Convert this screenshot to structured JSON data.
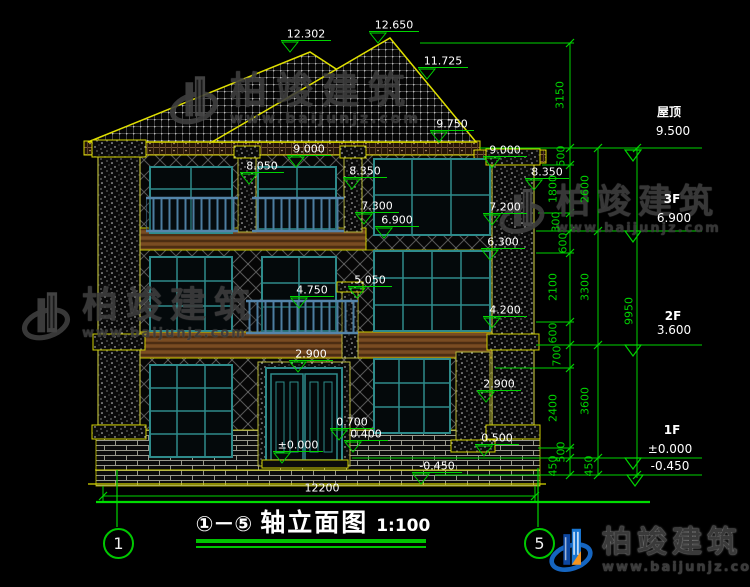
{
  "caption": {
    "axis_range": "①－⑤",
    "title": "轴立面图",
    "scale": "1:100"
  },
  "axes": {
    "left": "1",
    "right": "5"
  },
  "watermark": {
    "text": "柏竣建筑",
    "url": "www.baijunjz.com"
  },
  "logo": {
    "text": "柏竣建筑",
    "url": "www.baijunjz.com"
  },
  "levels": [
    {
      "label": "屋顶",
      "elevation": "9.500"
    },
    {
      "label": "3F",
      "elevation": "6.900"
    },
    {
      "label": "2F",
      "elevation": "3.600"
    },
    {
      "label": "1F",
      "elevation": "±0.000"
    },
    {
      "label": "室外地坪",
      "elevation": "-0.450"
    }
  ],
  "colors": {
    "background": "#000000",
    "dimension_green": "#00d400",
    "outline_yellow": "#d8d800",
    "window_teal": "#2e8b8b",
    "railing_blue": "#4d7da0",
    "wood_brown": "#6e431d",
    "watermark_gray": "#3d3d3d",
    "logo_blue": "#1565c0",
    "logo_orange": "#f5941d"
  },
  "annotations": [
    {
      "name": "elev-12302",
      "type": "level",
      "text": "12.302",
      "x": 306,
      "y": 34
    },
    {
      "name": "elev-12650",
      "type": "level",
      "text": "12.650",
      "x": 394,
      "y": 25
    },
    {
      "name": "elev-11725",
      "type": "level",
      "text": "11.725",
      "x": 443,
      "y": 61
    },
    {
      "name": "elev-9750",
      "type": "level",
      "text": "9.750",
      "x": 452,
      "y": 124
    },
    {
      "name": "elev-9000-left",
      "type": "level",
      "text": "9.000",
      "x": 309,
      "y": 149
    },
    {
      "name": "elev-8050",
      "type": "level",
      "text": "8.050",
      "x": 262,
      "y": 166
    },
    {
      "name": "elev-8350-left",
      "type": "level",
      "text": "8.350",
      "x": 365,
      "y": 171
    },
    {
      "name": "elev-7300",
      "type": "level",
      "text": "7.300",
      "x": 377,
      "y": 206
    },
    {
      "name": "elev-6900-left",
      "type": "level",
      "text": "6.900",
      "x": 397,
      "y": 220
    },
    {
      "name": "elev-5050",
      "type": "level",
      "text": "5.050",
      "x": 370,
      "y": 280
    },
    {
      "name": "elev-4750",
      "type": "level",
      "text": "4.750",
      "x": 312,
      "y": 290
    },
    {
      "name": "elev-2900-center",
      "type": "level",
      "text": "2.900",
      "x": 311,
      "y": 354
    },
    {
      "name": "elev-0700",
      "type": "level",
      "text": "0.700",
      "x": 352,
      "y": 422
    },
    {
      "name": "elev-0400",
      "type": "level",
      "text": "0.400",
      "x": 366,
      "y": 434
    },
    {
      "name": "elev-0000",
      "type": "level",
      "text": "±0.000",
      "x": 298,
      "y": 445
    },
    {
      "name": "elev-neg0450",
      "type": "level",
      "text": "-0.450",
      "x": 437,
      "y": 466
    },
    {
      "name": "elev-9000-right",
      "type": "level",
      "text": "9.000",
      "x": 505,
      "y": 150
    },
    {
      "name": "elev-8350-right",
      "type": "level",
      "text": "8.350",
      "x": 547,
      "y": 172
    },
    {
      "name": "elev-7200",
      "type": "level",
      "text": "7.200",
      "x": 505,
      "y": 207
    },
    {
      "name": "elev-6300",
      "type": "level",
      "text": "6.300",
      "x": 503,
      "y": 242
    },
    {
      "name": "elev-4200",
      "type": "level",
      "text": "4.200",
      "x": 505,
      "y": 310
    },
    {
      "name": "elev-2900-right",
      "type": "level",
      "text": "2.900",
      "x": 499,
      "y": 384
    },
    {
      "name": "elev-0500",
      "type": "level",
      "text": "0.500",
      "x": 497,
      "y": 438
    },
    {
      "name": "dim-3150",
      "type": "dim",
      "text": "3150",
      "x": 560,
      "y": 95
    },
    {
      "name": "dim-500-a",
      "type": "dim",
      "text": "500",
      "x": 561,
      "y": 156
    },
    {
      "name": "dim-1800",
      "type": "dim",
      "text": "1800",
      "x": 553,
      "y": 189
    },
    {
      "name": "dim-300",
      "type": "dim",
      "text": "300",
      "x": 556,
      "y": 222
    },
    {
      "name": "dim-600-a",
      "type": "dim",
      "text": "600",
      "x": 563,
      "y": 243
    },
    {
      "name": "dim-2100",
      "type": "dim",
      "text": "2100",
      "x": 553,
      "y": 287
    },
    {
      "name": "dim-600-b",
      "type": "dim",
      "text": "600",
      "x": 553,
      "y": 333
    },
    {
      "name": "dim-700",
      "type": "dim",
      "text": "700",
      "x": 557,
      "y": 356
    },
    {
      "name": "dim-2400",
      "type": "dim",
      "text": "2400",
      "x": 553,
      "y": 408
    },
    {
      "name": "dim-500-b",
      "type": "dim",
      "text": "500",
      "x": 561,
      "y": 452
    },
    {
      "name": "dim-450-a",
      "type": "dim",
      "text": "450",
      "x": 553,
      "y": 466
    },
    {
      "name": "dim-2600",
      "type": "dim",
      "text": "2600",
      "x": 585,
      "y": 189
    },
    {
      "name": "dim-3300",
      "type": "dim",
      "text": "3300",
      "x": 585,
      "y": 287
    },
    {
      "name": "dim-3600",
      "type": "dim",
      "text": "3600",
      "x": 585,
      "y": 401
    },
    {
      "name": "dim-450-b",
      "type": "dim",
      "text": "450",
      "x": 589,
      "y": 466
    },
    {
      "name": "dim-9950",
      "type": "dim",
      "text": "9950",
      "x": 629,
      "y": 311
    },
    {
      "name": "level-roof-label",
      "type": "text",
      "bold": true,
      "text": "屋顶",
      "x": 669,
      "y": 112,
      "size": 12
    },
    {
      "name": "level-roof-elev",
      "type": "text",
      "text": "9.500",
      "x": 673,
      "y": 131,
      "size": 12
    },
    {
      "name": "level-3f-label",
      "type": "text",
      "bold": true,
      "text": "3F",
      "x": 672,
      "y": 199,
      "size": 12
    },
    {
      "name": "level-3f-elev",
      "type": "text",
      "text": "6.900",
      "x": 674,
      "y": 218,
      "size": 12
    },
    {
      "name": "level-2f-label",
      "type": "text",
      "bold": true,
      "text": "2F",
      "x": 673,
      "y": 316,
      "size": 12
    },
    {
      "name": "level-2f-elev",
      "type": "text",
      "text": "3.600",
      "x": 674,
      "y": 330,
      "size": 12
    },
    {
      "name": "level-1f-label",
      "type": "text",
      "bold": true,
      "text": "1F",
      "x": 672,
      "y": 430,
      "size": 12
    },
    {
      "name": "level-1f-elev",
      "type": "text",
      "text": "±0.000",
      "x": 670,
      "y": 449,
      "size": 12
    },
    {
      "name": "level-ground-elev",
      "type": "text",
      "text": "-0.450",
      "x": 670,
      "y": 466,
      "size": 12
    },
    {
      "name": "dim-12200",
      "type": "text",
      "text": "12200",
      "x": 322,
      "y": 488,
      "size": 11
    }
  ]
}
